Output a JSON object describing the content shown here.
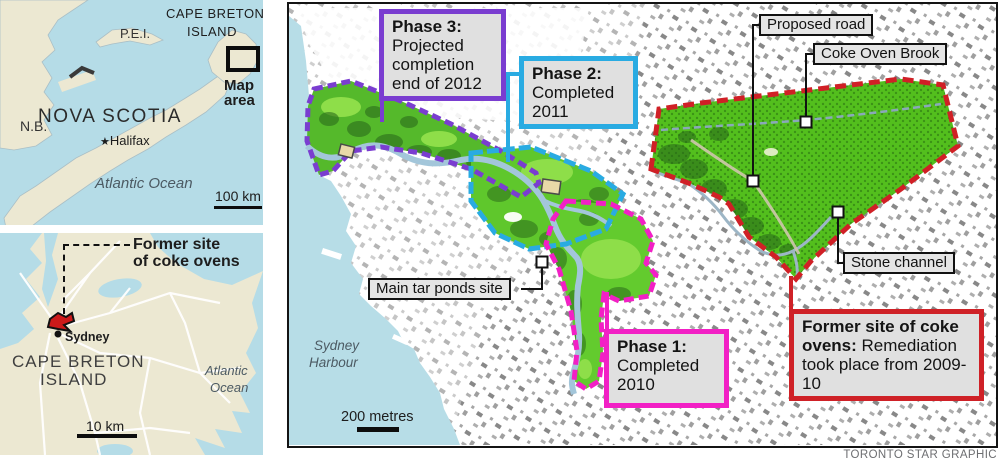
{
  "credit": "TORONTO STAR GRAPHIC",
  "inset_ns": {
    "nb": "N.B.",
    "pei": "P.E.I.",
    "cbi_line1": "CAPE BRETON",
    "cbi_line2": "ISLAND",
    "province": "NOVA SCOTIA",
    "halifax_star": "★",
    "halifax": "Halifax",
    "ocean": "Atlantic Ocean",
    "scale": "100 km",
    "map_area_line1": "Map",
    "map_area_line2": "area"
  },
  "inset_cb": {
    "callout_line1": "Former site",
    "callout_line2": "of coke ovens",
    "city": "Sydney",
    "island_line1": "CAPE BRETON",
    "island_line2": "ISLAND",
    "ocean_line1": "Atlantic",
    "ocean_line2": "Ocean",
    "scale": "10 km"
  },
  "main": {
    "harbour_line1": "Sydney",
    "harbour_line2": "Harbour",
    "scale": "200 metres",
    "phase3": {
      "title": "Phase 3:",
      "lines": [
        "Projected",
        "completion",
        "end of 2012"
      ]
    },
    "phase2": {
      "title": "Phase 2:",
      "lines": [
        "Completed",
        "2011"
      ]
    },
    "phase1": {
      "title": "Phase 1:",
      "lines": [
        "Completed",
        "2010"
      ]
    },
    "coke_box": {
      "bold": "Former site of coke ovens:",
      "rest": " Remediation took place from 2009-10"
    },
    "tar_ponds_label": "Main tar ponds site",
    "proposed_road_label": "Proposed road",
    "coke_brook_label": "Coke Oven Brook",
    "stone_channel_label": "Stone channel"
  },
  "colors": {
    "phase3_purple": "#7a3dd0",
    "phase2_cyan": "#29abe2",
    "phase1_magenta": "#f220c5",
    "coke_red": "#cf2127",
    "water": "#b5dce7",
    "inset_land": "#ece8d2",
    "park_green": "#5cc228",
    "label_bg": "#e5e5e5"
  }
}
